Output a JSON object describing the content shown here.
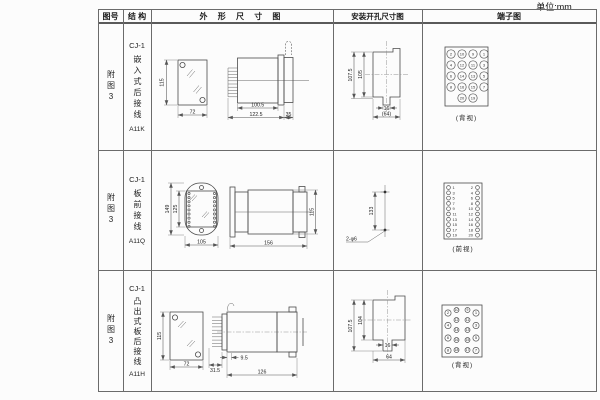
{
  "unit_label": "单位:mm",
  "header": {
    "figure": "图号",
    "structure": "结 构",
    "outline": "外 形 尺 寸 图",
    "install": "安装开孔尺寸图",
    "terminal": "端子图"
  },
  "rows": [
    {
      "figure": "附图3",
      "model": "CJ-1",
      "structure_chars": "嵌入式后接线",
      "code": "A11K",
      "outline": {
        "h": "115",
        "w": "72",
        "d1": "100.5",
        "d2": "122.5",
        "d3": "35"
      },
      "install": {
        "v1": "107.5",
        "v2": "105",
        "n": "16",
        "b": "(64)"
      },
      "terminal_view": "(背视)"
    },
    {
      "figure": "附图3",
      "model": "CJ-1",
      "structure_chars": "板前接线",
      "code": "A11Q",
      "outline": {
        "h1": "149",
        "h2": "125",
        "w": "105",
        "sw": "156",
        "sh": "115"
      },
      "install": {
        "v1": "133",
        "holes": "2-φ6"
      },
      "terminal_view": "(前视)"
    },
    {
      "figure": "附图3",
      "model": "CJ-1",
      "structure_chars": "凸出式板后接线",
      "code": "A11H",
      "outline": {
        "h": "115",
        "w": "72",
        "d1": "9.5",
        "d2": "31.5",
        "d3": "126"
      },
      "install": {
        "v1": "107.5",
        "v2": "104",
        "n": "16",
        "b": "64"
      },
      "terminal_view": "(背视)"
    }
  ],
  "terminal_numbers": {
    "row1": [
      [
        "2",
        "10",
        "9",
        "1"
      ],
      [
        "4",
        "12",
        "11",
        "3"
      ],
      [
        "6",
        "14",
        "13",
        "5"
      ],
      [
        "8",
        "16",
        "15",
        "7"
      ],
      [
        "20",
        "19"
      ]
    ],
    "row2_left": [
      "1",
      "3",
      "5",
      "7",
      "9",
      "11",
      "13",
      "15",
      "17",
      "19"
    ],
    "row2_right": [
      "2",
      "4",
      "6",
      "8",
      "10",
      "12",
      "14",
      "16",
      "18",
      "20"
    ],
    "row3": {
      "outer_left": [
        "2",
        "4",
        "6",
        "8"
      ],
      "inner_left": [
        "10",
        "12",
        "14",
        "16",
        "18"
      ],
      "inner_right": [
        "9",
        "11",
        "13",
        "15",
        "17"
      ],
      "outer_right": [
        "1",
        "3",
        "5",
        "7"
      ]
    }
  }
}
